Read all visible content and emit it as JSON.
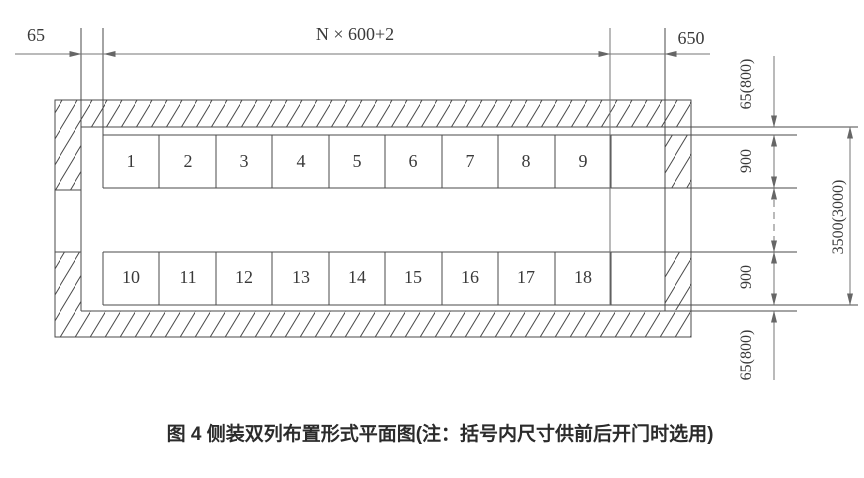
{
  "figure": {
    "caption": "图 4  侧装双列布置形式平面图(注：括号内尺寸供前后开门时选用)",
    "dims": {
      "left_clearance": "65",
      "row_width": "N × 600+2",
      "end_clearance": "650",
      "top_clearance": "65(800)",
      "row1_depth": "900",
      "row2_depth": "900",
      "bottom_clearance": "65(800)",
      "total_depth": "3500(3000)"
    },
    "row1_cells": [
      "1",
      "2",
      "3",
      "4",
      "5",
      "6",
      "7",
      "8",
      "9"
    ],
    "row2_cells": [
      "10",
      "11",
      "12",
      "13",
      "14",
      "15",
      "16",
      "17",
      "18"
    ],
    "colors": {
      "line": "#4a4a4a",
      "dim_line": "#767676",
      "text": "#3a3a3a",
      "background": "#ffffff"
    }
  }
}
